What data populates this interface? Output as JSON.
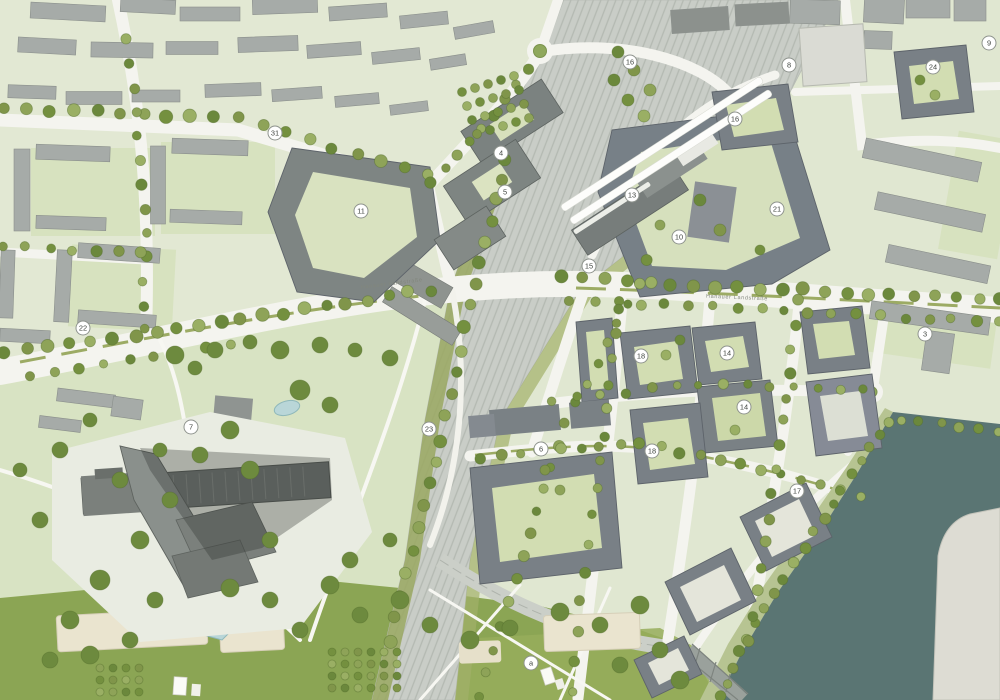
{
  "map": {
    "street_labels": [
      {
        "id": "hanauer-west",
        "text": "Hanauer Landstraße",
        "x": 392,
        "y": 285,
        "rotation": -7
      },
      {
        "id": "hanauer-east",
        "text": "Hanauer Landstraße",
        "x": 737,
        "y": 299,
        "rotation": 2.5
      }
    ],
    "markers": [
      {
        "label": "31",
        "x": 275,
        "y": 133
      },
      {
        "label": "11",
        "x": 361,
        "y": 211
      },
      {
        "label": "4",
        "x": 501,
        "y": 153
      },
      {
        "label": "5",
        "x": 505,
        "y": 192
      },
      {
        "label": "16",
        "x": 630,
        "y": 62
      },
      {
        "label": "13",
        "x": 632,
        "y": 195
      },
      {
        "label": "15",
        "x": 589,
        "y": 266
      },
      {
        "label": "10",
        "x": 679,
        "y": 237
      },
      {
        "label": "21",
        "x": 777,
        "y": 209
      },
      {
        "label": "16",
        "x": 735,
        "y": 119
      },
      {
        "label": "8",
        "x": 789,
        "y": 65
      },
      {
        "label": "24",
        "x": 933,
        "y": 67
      },
      {
        "label": "9",
        "x": 989,
        "y": 43
      },
      {
        "label": "3",
        "x": 925,
        "y": 334
      },
      {
        "label": "22",
        "x": 83,
        "y": 328
      },
      {
        "label": "7",
        "x": 191,
        "y": 427
      },
      {
        "label": "23",
        "x": 429,
        "y": 429
      },
      {
        "label": "6",
        "x": 541,
        "y": 449
      },
      {
        "label": "18",
        "x": 641,
        "y": 356
      },
      {
        "label": "14",
        "x": 727,
        "y": 353
      },
      {
        "label": "14",
        "x": 744,
        "y": 407
      },
      {
        "label": "18",
        "x": 652,
        "y": 451
      },
      {
        "label": "17",
        "x": 797,
        "y": 491
      },
      {
        "label": "a",
        "x": 531,
        "y": 663
      }
    ],
    "colors": {
      "water": "#5a7573",
      "river_island": "#dddcd3",
      "lawn": "#8ba554",
      "park": "#d8e3c3",
      "parcel": "#e1e8d2",
      "courtyard": "#d2ddb2",
      "building_new": "#798086",
      "building_existing": "#a6aba8",
      "road": "#f4f4ef",
      "rail": "#c9cdc7",
      "tree": "#80954a",
      "pond": "#b9d6d8",
      "sand_field": "#eae4cf",
      "badge_fill": "#ffffff",
      "badge_ring": "#8f948e"
    }
  }
}
